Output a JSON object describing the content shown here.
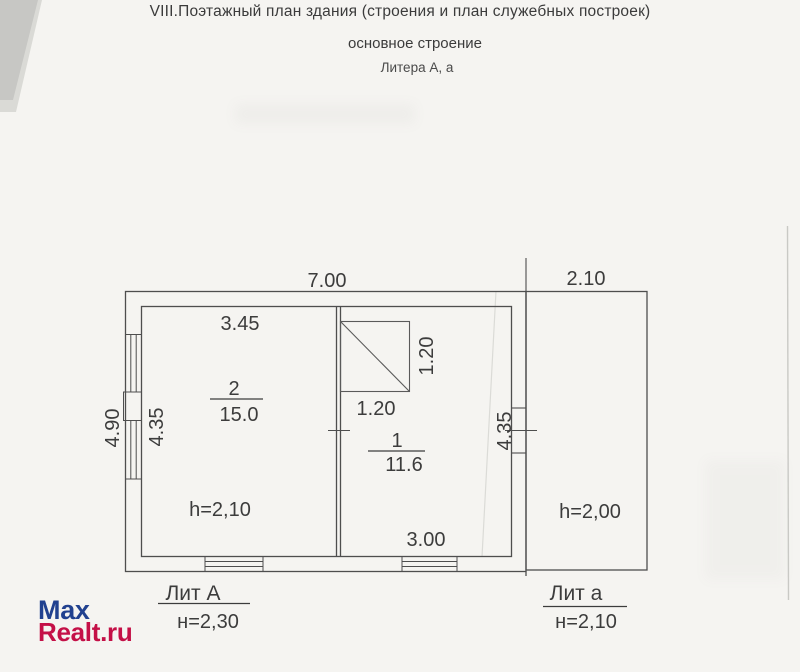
{
  "header": {
    "title": "VIII.Поэтажный план здания (строения и план служебных построек)",
    "subtitle": "основное строение",
    "litera": "Литера А, а"
  },
  "plan": {
    "dims": {
      "top_main": "7.00",
      "top_annex": "2.10",
      "room2_width": "3.45",
      "outer_height": "4.90",
      "inner_height_left": "4.35",
      "inner_height_right": "4.35",
      "stove_height": "1.20",
      "stove_width": "1.20",
      "room1_width": "3.00"
    },
    "rooms": {
      "room2": {
        "number": "2",
        "area": "15.0",
        "ceiling": "h=2,10"
      },
      "room1": {
        "number": "1",
        "area": "11.6"
      },
      "annex": {
        "ceiling": "h=2,00"
      }
    },
    "legend": {
      "main": {
        "litera": "Лит А",
        "height": "н=2,30"
      },
      "annex": {
        "litera": "Лит а",
        "height": "н=2,10"
      }
    }
  },
  "watermark": {
    "line1": "Max",
    "line2": "Realt.ru"
  },
  "colors": {
    "paper": "#f5f4f1",
    "ink_line": "#4e4e4e",
    "ink_text": "#3c3c3c",
    "watermark_blue": "#21418f",
    "watermark_red": "#c41047"
  }
}
